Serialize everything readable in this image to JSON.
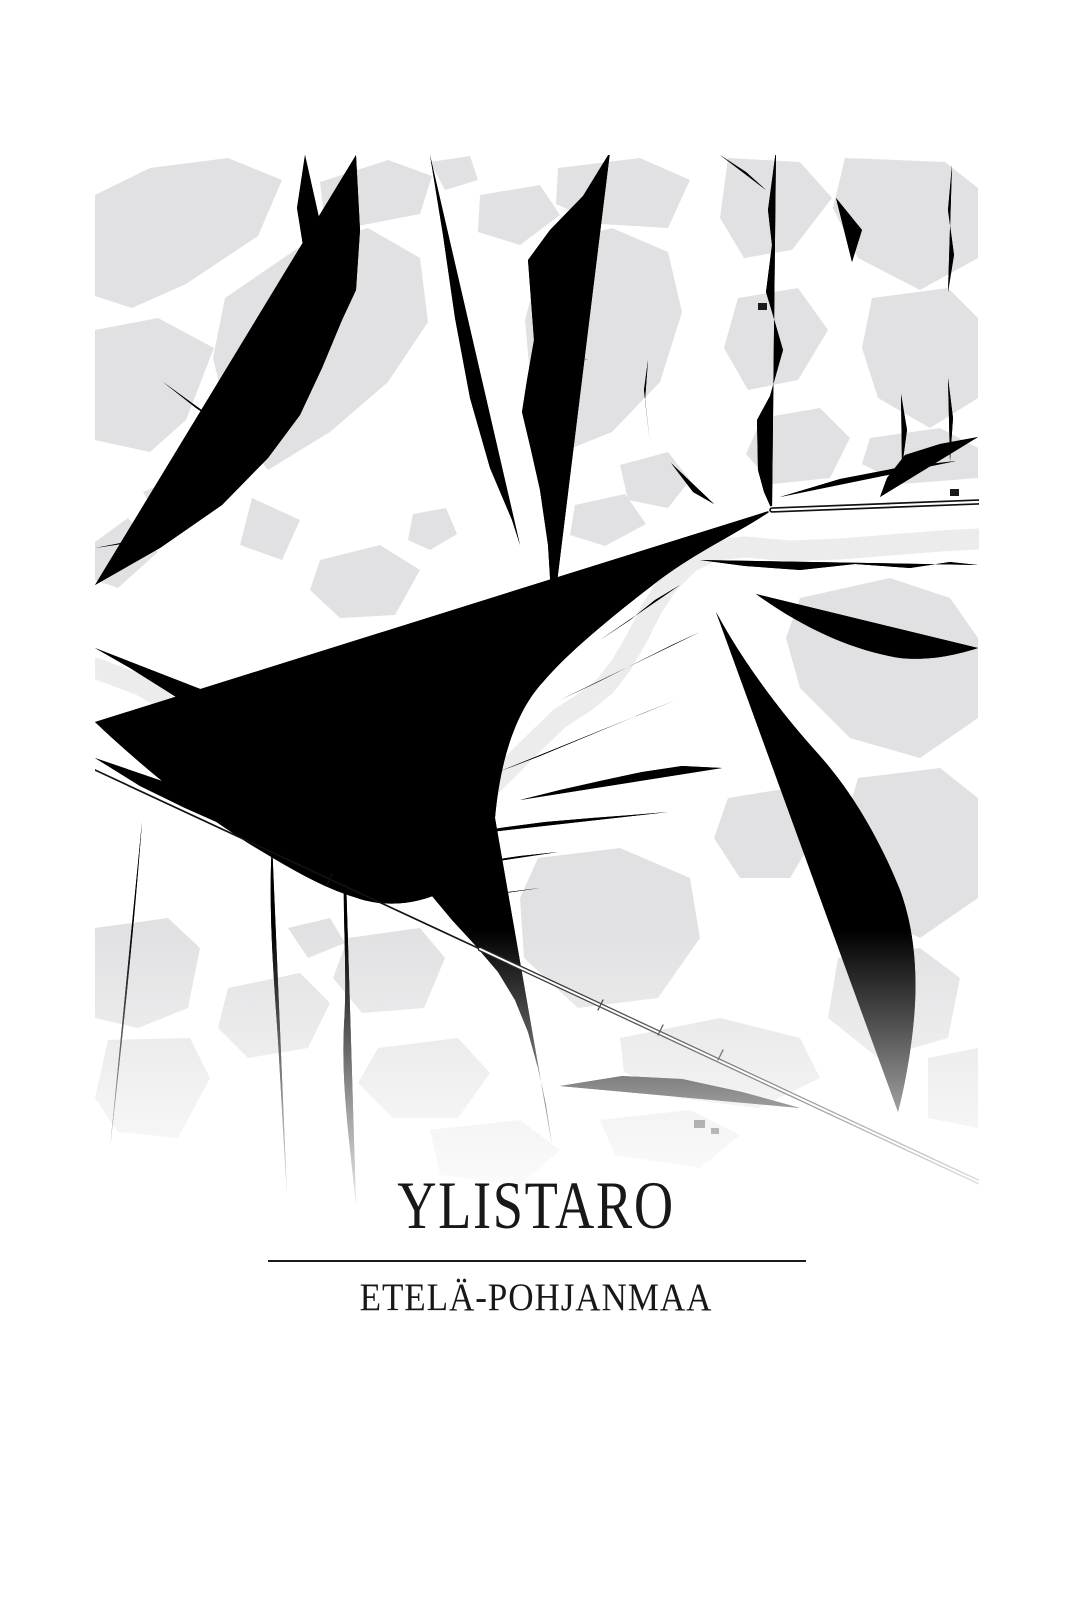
{
  "poster": {
    "city": "YLISTARO",
    "region": "ETELÄ-POHJANMAA",
    "colors": {
      "background": "#ffffff",
      "land": "#e1e1e3",
      "water": "#ececec",
      "roads": "#171717",
      "text": "#181818"
    }
  }
}
